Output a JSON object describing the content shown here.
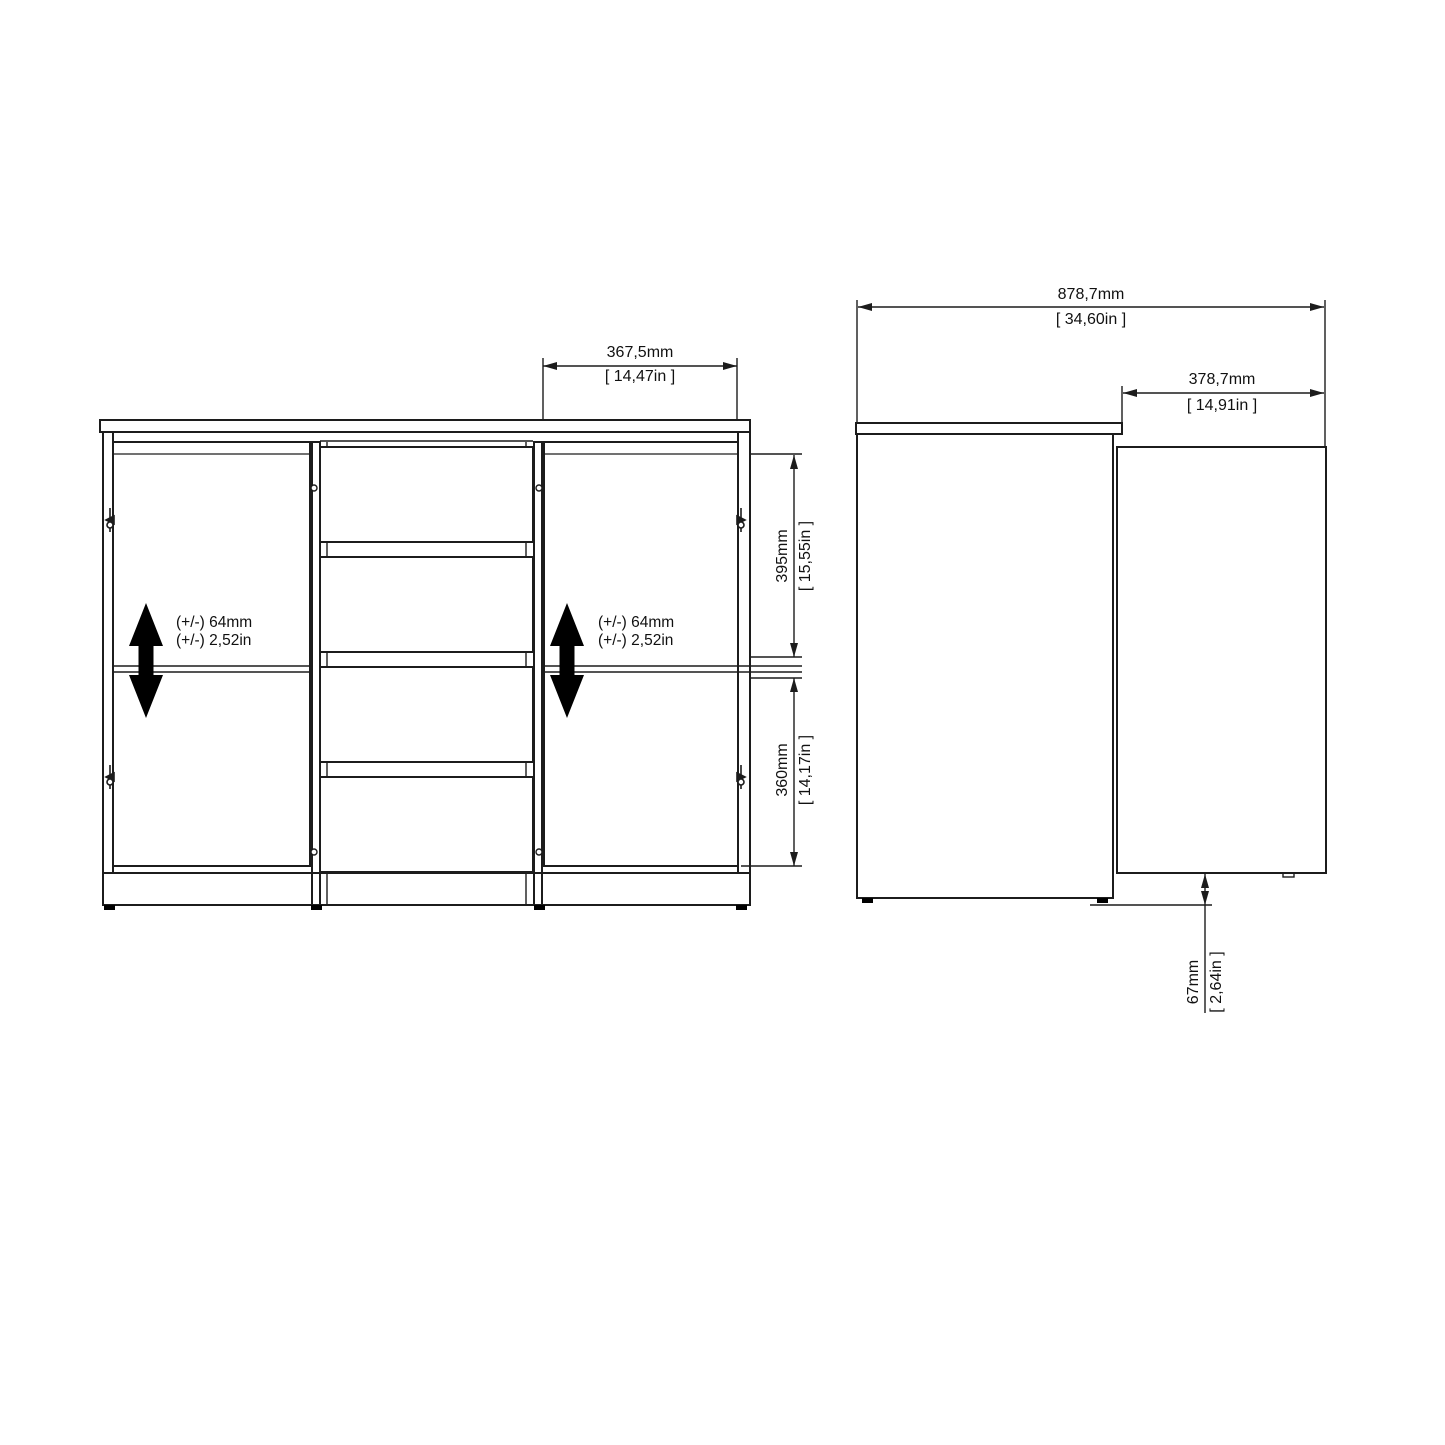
{
  "front_view": {
    "door_width": {
      "mm": "367,5mm",
      "inch": "[ 14,47in ]"
    },
    "upper_opening": {
      "mm": "395mm",
      "inch": "[ 15,55in ]"
    },
    "lower_opening": {
      "mm": "360mm",
      "inch": "[ 14,17in ]"
    },
    "shelf_adjustability": {
      "mm": "(+/-) 64mm",
      "inch": "(+/-) 2,52in"
    }
  },
  "side_view": {
    "total_depth_door_open": {
      "mm": "878,7mm",
      "inch": "[ 34,60in ]"
    },
    "open_door_projection": {
      "mm": "378,7mm",
      "inch": "[ 14,91in ]"
    },
    "door_floor_clearance": {
      "mm": "67mm",
      "inch": "[ 2,64in ]"
    }
  },
  "colors": {
    "line": "#1c1c1c",
    "background": "#ffffff",
    "arrow": "#000000"
  }
}
